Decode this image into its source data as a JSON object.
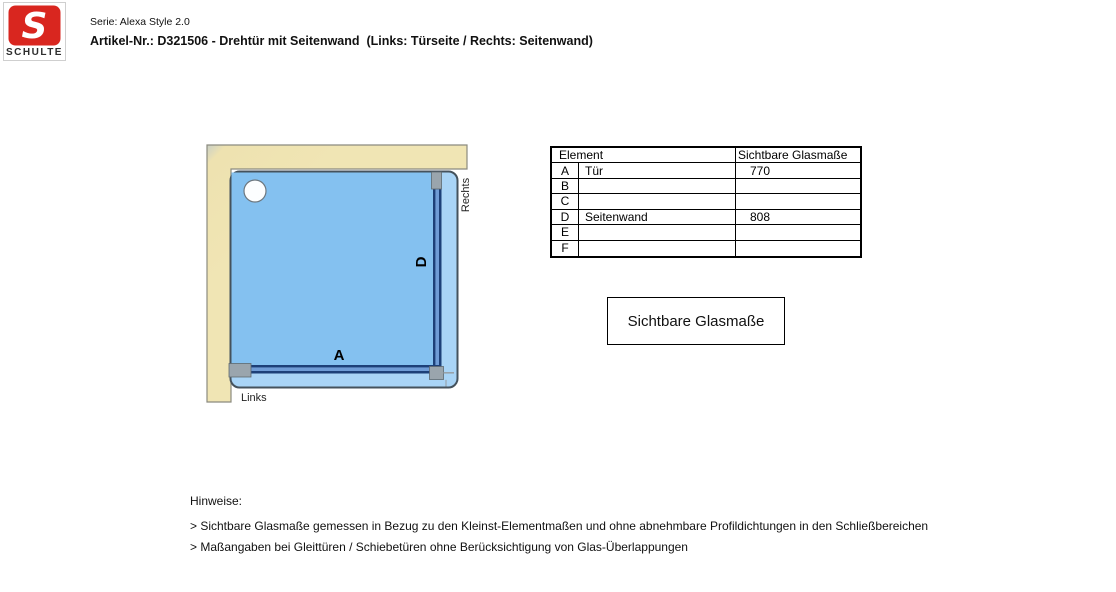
{
  "header": {
    "logo": {
      "monogram": "S",
      "brand": "SCHULTE",
      "red": "#d9261f"
    },
    "serie": "Serie: Alexa Style 2.0",
    "artikel": "Artikel-Nr.: D321506 - Drehtür mit Seitenwand  (Links: Türseite / Rechts: Seitenwand)"
  },
  "diagram": {
    "labels": {
      "door": "A",
      "side_panel": "D",
      "right_side": "Rechts",
      "left_side": "Links"
    },
    "colors": {
      "wall": "#efe3b1",
      "wall_border": "#8b8b7f",
      "tray_outer": "#a9d4f6",
      "tray_inner": "#84c1f0",
      "tray_border": "#45525c",
      "glass_dark": "#1d4078",
      "glass_light": "#6f9cd6",
      "bracket": "#9aa5ad"
    }
  },
  "table": {
    "header": {
      "element": "Element",
      "value": "Sichtbare Glasmaße"
    },
    "rows": [
      {
        "key": "A",
        "name": "Tür",
        "value": "770"
      },
      {
        "key": "B",
        "name": "",
        "value": ""
      },
      {
        "key": "C",
        "name": "",
        "value": ""
      },
      {
        "key": "D",
        "name": "Seitenwand",
        "value": "808"
      },
      {
        "key": "E",
        "name": "",
        "value": ""
      },
      {
        "key": "F",
        "name": "",
        "value": ""
      }
    ]
  },
  "legend_box": {
    "label": "Sichtbare Glasmaße"
  },
  "notes": {
    "title": "Hinweise:",
    "items": [
      "> Sichtbare Glasmaße gemessen in Bezug zu den Kleinst-Elementmaßen und ohne abnehmbare Profildichtungen in den Schließbereichen",
      "> Maßangaben bei Gleittüren / Schiebetüren ohne Berücksichtigung von Glas-Überlappungen"
    ]
  }
}
